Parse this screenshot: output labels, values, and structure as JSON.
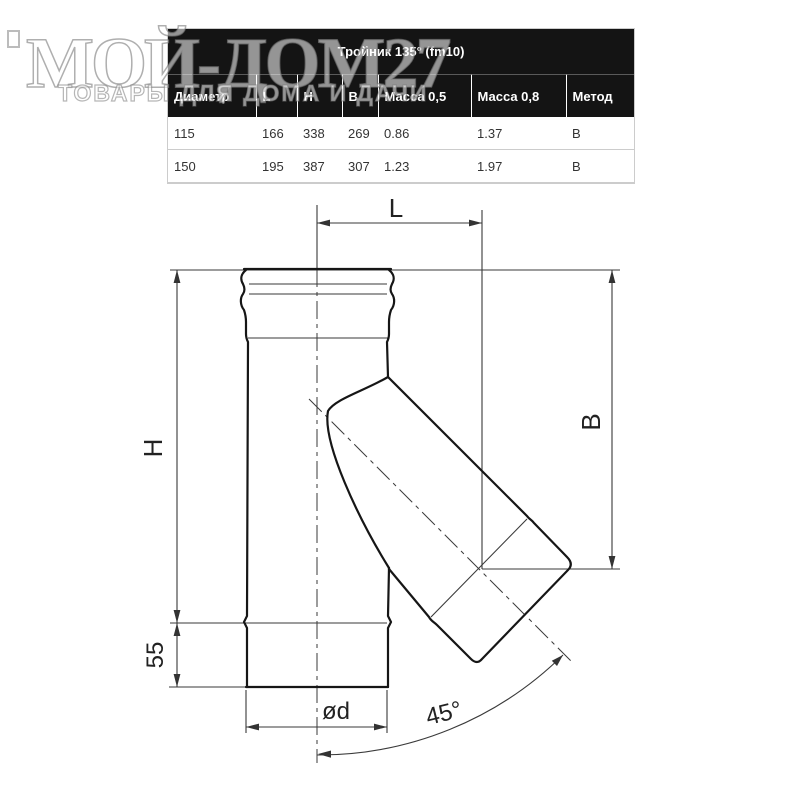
{
  "watermark": {
    "title": "МОЙ-ДОМ27",
    "subtitle": "ТОВАРЫ ДЛЯ ДОМА И ДАЧИ"
  },
  "table": {
    "title": "Тройник 135° (fm10)",
    "headers": [
      "Диаметр",
      "L",
      "Н",
      "В",
      "Масса 0,5",
      "Масса 0,8",
      "Метод"
    ],
    "rows": [
      [
        "115",
        "166",
        "338",
        "269",
        "0.86",
        "1.37",
        "В"
      ],
      [
        "150",
        "195",
        "387",
        "307",
        "1.23",
        "1.97",
        "В"
      ]
    ]
  },
  "drawing": {
    "labels": {
      "length": "L",
      "height": "H",
      "branch_height": "B",
      "bottom_offset": "55",
      "diameter": "ød",
      "angle": "45°"
    }
  },
  "colors": {
    "table_header_bg": "#141414",
    "body_text": "#333333",
    "drawing_line": "#161616"
  }
}
